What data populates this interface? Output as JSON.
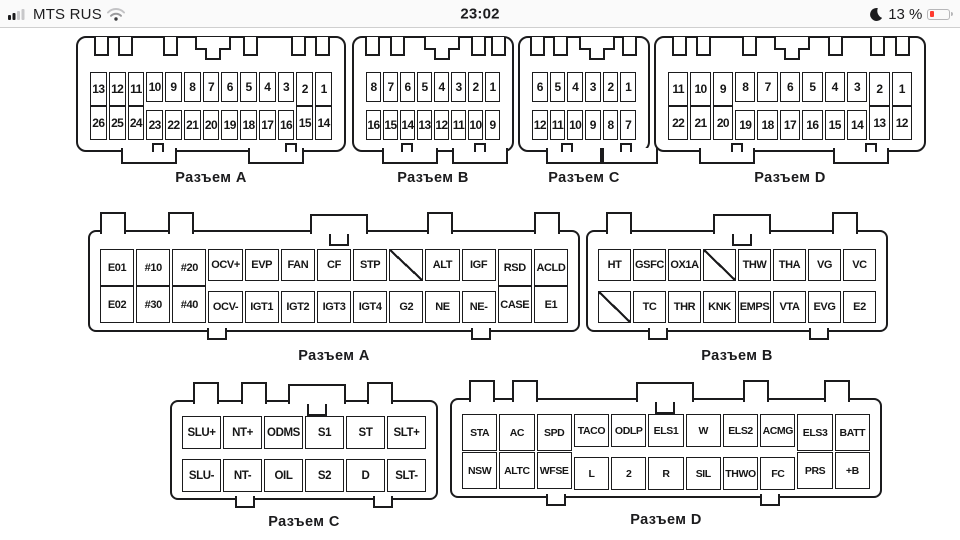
{
  "status_bar": {
    "carrier": "MTS RUS",
    "time": "23:02",
    "battery_percent": "13 %",
    "icons": {
      "signal": "cellular-signal-bars",
      "wifi": "wifi-icon",
      "moon": "do-not-disturb-moon-icon",
      "battery": "battery-low-icon"
    },
    "colors": {
      "battery_fill": "#ff3b30",
      "inactive_gray": "#c8c8ca",
      "active_dark": "#1c1c1e"
    }
  },
  "diagram": {
    "ink_color": "#1b1b1d",
    "connectors": [
      {
        "id": "top-a",
        "label": "Разъем A",
        "cols": 13,
        "tall_left": 3,
        "tall_right": 2,
        "rows": [
          [
            "13",
            "12",
            "11",
            "10",
            "9",
            "8",
            "7",
            "6",
            "5",
            "4",
            "3",
            "2",
            "1"
          ],
          [
            "26",
            "25",
            "24",
            "23",
            "22",
            "21",
            "20",
            "19",
            "18",
            "17",
            "16",
            "15",
            "14"
          ]
        ]
      },
      {
        "id": "top-b",
        "label": "Разъем B",
        "cols": 8,
        "tall_left": 0,
        "tall_right": 0,
        "rows": [
          [
            "8",
            "7",
            "6",
            "5",
            "4",
            "3",
            "2",
            "1"
          ],
          [
            "16",
            "15",
            "14",
            "13",
            "12",
            "11",
            "10",
            "9"
          ]
        ]
      },
      {
        "id": "top-c",
        "label": "Разъем C",
        "cols": 6,
        "tall_left": 0,
        "tall_right": 0,
        "rows": [
          [
            "6",
            "5",
            "4",
            "3",
            "2",
            "1"
          ],
          [
            "12",
            "11",
            "10",
            "9",
            "8",
            "7"
          ]
        ]
      },
      {
        "id": "top-d",
        "label": "Разъем D",
        "cols": 11,
        "tall_left": 3,
        "tall_right": 2,
        "rows": [
          [
            "11",
            "10",
            "9",
            "8",
            "7",
            "6",
            "5",
            "4",
            "3",
            "2",
            "1"
          ],
          [
            "22",
            "21",
            "20",
            "19",
            "18",
            "17",
            "16",
            "15",
            "14",
            "13",
            "12"
          ]
        ]
      },
      {
        "id": "mid-a",
        "label": "Разъем A",
        "cols": 13,
        "tall_left": 3,
        "tall_right": 2,
        "rows": [
          [
            "E01",
            "#10",
            "#20",
            "OCV+",
            "EVP",
            "FAN",
            "CF",
            "STP",
            "/",
            "ALT",
            "IGF",
            "RSD",
            "ACLD"
          ],
          [
            "E02",
            "#30",
            "#40",
            "OCV-",
            "IGT1",
            "IGT2",
            "IGT3",
            "IGT4",
            "G2",
            "NE",
            "NE-",
            "CASE",
            "E1"
          ]
        ]
      },
      {
        "id": "mid-b",
        "label": "Разъем B",
        "cols": 8,
        "tall_left": 0,
        "tall_right": 0,
        "rows": [
          [
            "HT",
            "GSFC",
            "OX1A",
            "/",
            "THW",
            "THA",
            "VG",
            "VC"
          ],
          [
            "/",
            "TC",
            "THR",
            "KNK",
            "EMPS",
            "VTA",
            "EVG",
            "E2"
          ]
        ]
      },
      {
        "id": "bot-c",
        "label": "Разъем C",
        "cols": 6,
        "tall_left": 0,
        "tall_right": 0,
        "rows": [
          [
            "SLU+",
            "NT+",
            "ODMS",
            "S1",
            "ST",
            "SLT+"
          ],
          [
            "SLU-",
            "NT-",
            "OIL",
            "S2",
            "D",
            "SLT-"
          ]
        ]
      },
      {
        "id": "bot-d",
        "label": "Разъем D",
        "cols": 11,
        "tall_left": 3,
        "tall_right": 2,
        "rows": [
          [
            "STA",
            "AC",
            "SPD",
            "TACO",
            "ODLP",
            "ELS1",
            "W",
            "ELS2",
            "ACMG",
            "ELS3",
            "BATT"
          ],
          [
            "NSW",
            "ALTC",
            "WFSE",
            "L",
            "2",
            "R",
            "SIL",
            "THWO",
            "FC",
            "PRS",
            "+B"
          ]
        ]
      }
    ]
  }
}
